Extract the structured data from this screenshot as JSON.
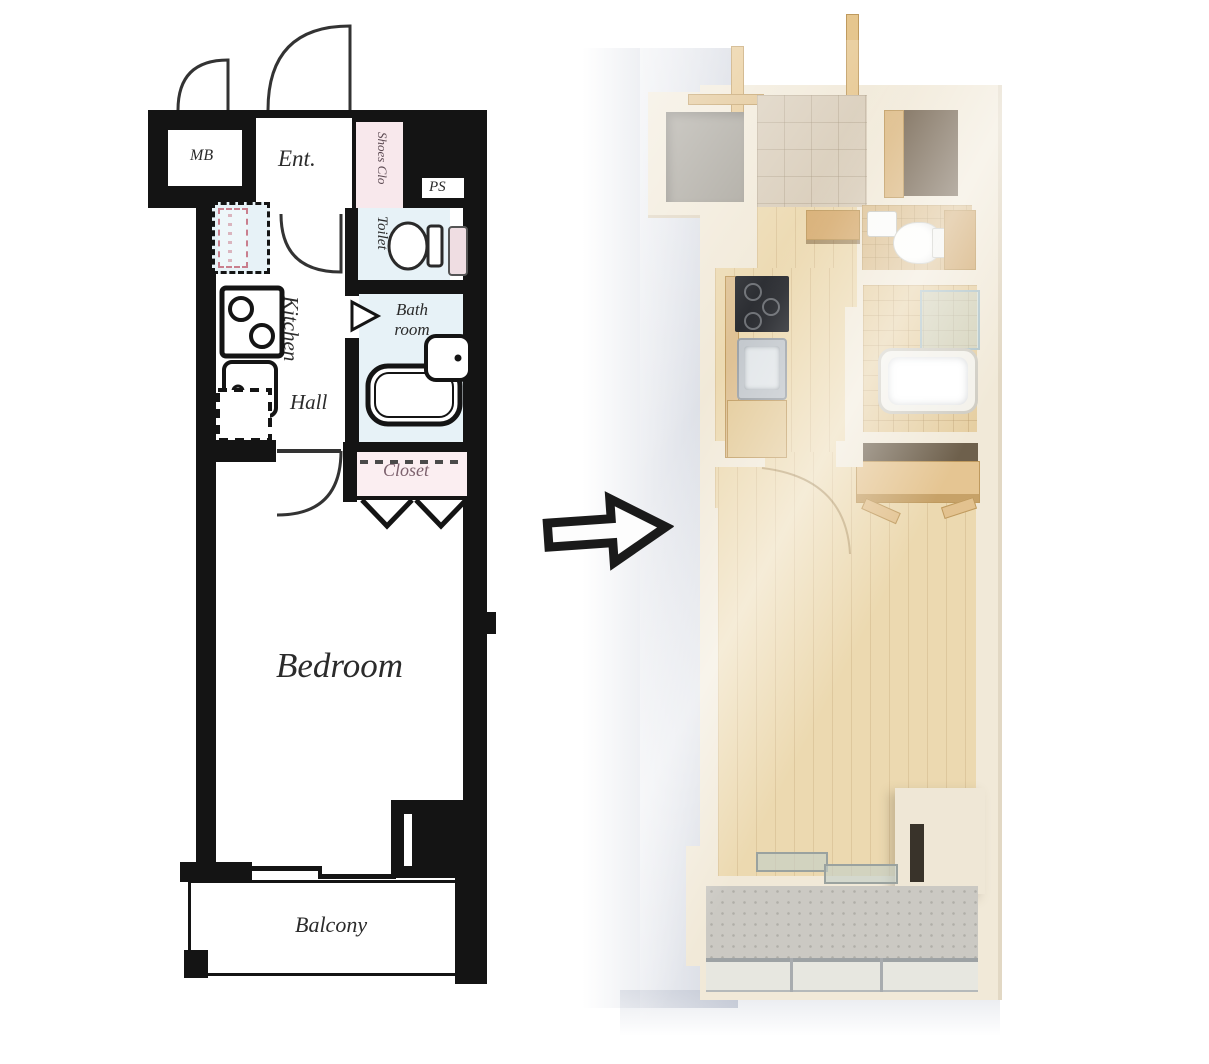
{
  "plan2d": {
    "rooms": {
      "mb": "MB",
      "entrance": "Ent.",
      "shoes_closet": "Shoes Clo",
      "pipe_space": "PS",
      "toilet": "Toilet",
      "bath_line1": "Bath",
      "bath_line2": "room",
      "kitchen": "Kitchen",
      "hall": "Hall",
      "refrigerator": "R",
      "closet": "Closet",
      "bedroom": "Bedroom",
      "balcony": "Balcony"
    },
    "colors": {
      "wall": "#141414",
      "wet_area_bg": "#e7f2f7",
      "shoes_closet_bg": "#f8e8ec",
      "closet_bg": "#fbeef1",
      "label_text": "#2b2b2b",
      "closet_label_text": "#7d626e"
    }
  },
  "transform_arrow": {
    "direction": "right"
  },
  "render3d": {
    "palette": {
      "wall": "#f1e9d8",
      "wood_floor": "#ecd9b0",
      "entry_tile": "#d9cdba",
      "bath_tile": "#e6cfa2",
      "toilet_tile": "#ddc193",
      "concrete": "#a7a39a",
      "balcony_concrete": "#cbc9c3",
      "fixture_white": "#fafaf7",
      "stove_black": "#24262b",
      "wood_furniture": "#dcb983",
      "soft_shadow": "#7884a0"
    }
  }
}
